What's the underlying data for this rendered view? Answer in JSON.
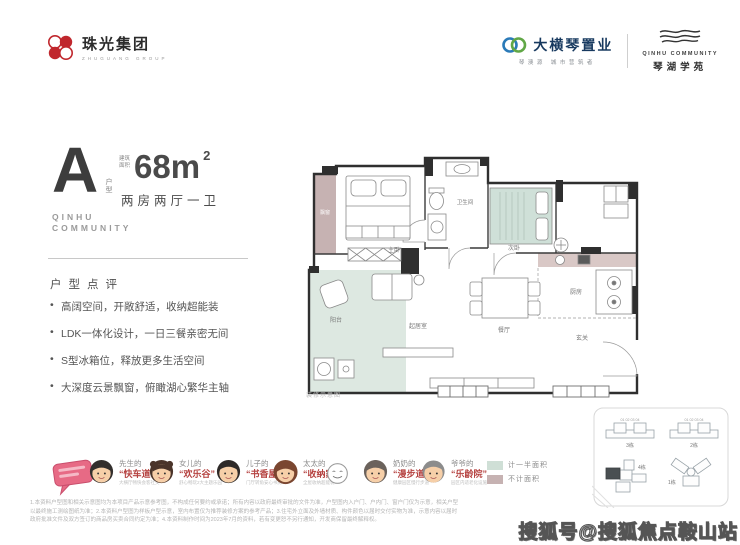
{
  "header": {
    "group_logo": {
      "cn": "珠光集团",
      "en": "ZHUGUANG GROUP"
    },
    "developer_logo": {
      "cn": "大横琴置业",
      "slogan": "琴澳源 城市营筑者"
    },
    "project_logo": {
      "en": "QINHU COMMUNITY",
      "cn": "琴湖学苑"
    }
  },
  "unit": {
    "type_letter": "A",
    "type_label": "户型",
    "area_prefix": "建筑面积",
    "area_value": "68m",
    "area_sup": "2",
    "layout": "两房两厅一卫",
    "community_line1": "QINHU",
    "community_line2": "COMMUNITY"
  },
  "review": {
    "heading": "户型点评",
    "bullets": [
      "高阔空间，开敞舒适，收纳超能装",
      "LDK一体化设计，一日三餐亲密无间",
      "S型冰箱位，释放更多生活空间",
      "大深度云景飘窗，俯瞰湖心繁华主轴"
    ]
  },
  "floorplan": {
    "caption": "装修示意图",
    "rooms": {
      "bay_window": "飘窗",
      "master_bedroom": "主卧",
      "bathroom": "卫生间",
      "second_bedroom": "次卧",
      "kitchen": "厨房",
      "dining": "餐厅",
      "entry": "玄关",
      "living": "起居室",
      "balcony": "阳台"
    }
  },
  "legend": {
    "half_area": {
      "label": "计一半面积",
      "color": "#cfdfd6"
    },
    "excluded_area": {
      "label": "不计面积",
      "color": "#c6b2b2"
    }
  },
  "family": {
    "members": [
      {
        "who": "先生的",
        "tag": "“快车道”",
        "note": "大横厅畅快会客社交"
      },
      {
        "who": "女儿的",
        "tag": "“欢乐谷”",
        "note": "舒心畅玩2大主题乐园"
      },
      {
        "who": "儿子的",
        "tag": "“书香屋”",
        "note": "门厅转角安心书房"
      },
      {
        "who": "太太的",
        "tag": "“收纳家”",
        "note": "全屋收纳超能装"
      },
      {
        "who": "奶奶的",
        "tag": "“漫步道”",
        "note": "健康园区慢行步道"
      },
      {
        "who": "爷爷的",
        "tag": "“乐龄院”",
        "note": "园区内适老化设施"
      }
    ]
  },
  "sitemap": {
    "buildings": [
      "3栋",
      "2栋",
      "4栋",
      "1栋"
    ],
    "unit_numbers": "01 02 03 04"
  },
  "disclaimer": {
    "line1": "1.本资料户型图和相关示意图均为本项目产品示意参考图，不构成任何要约或承诺；所有内容以政府最终审批的文件为准，户型图内入户门、户内门、窗户门仅为示意，相关户型",
    "line2": "以最终施工测绘图纸为准；2.本资料户型图为样板户型示意，室内布置仅为推荐装修方案的参考产品；3.住宅外立面及外墙材质、构件颜色以届时交付实物为准，示意内容以届时",
    "line3": "政府批准文件及双方签订的商品房买卖合同约定为准；4.本资料制作时间为2023年7月的资料，若有变更恕不另行通知，开发商保留最终解释权。"
  },
  "watermark": "搜狐号@搜狐焦点鞍山站"
}
